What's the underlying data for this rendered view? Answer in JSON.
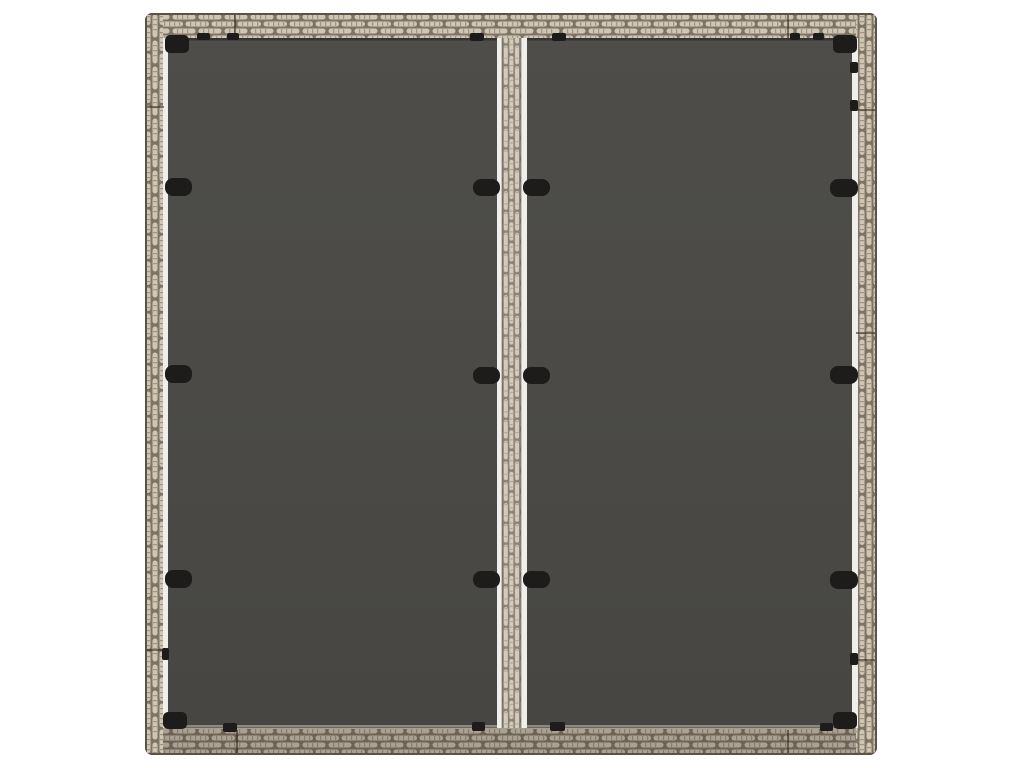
{
  "scene": {
    "alt_text": "Top-down product photo of a square grey poly rattan garden table top with two dark grey glass panels, a central rattan divider strip with white trim, and black glass retaining clips, on a plain white background.",
    "background_color": "#ffffff"
  },
  "photo": {
    "x": 145,
    "y": 13,
    "width": 732,
    "height": 742
  },
  "colors": {
    "background": "#ffffff",
    "glass": "#4b4a46",
    "glass_light": "#4e4d49",
    "glass_dark": "#474643",
    "strand": "#cfc6b4",
    "strand_tick": "#8b8272",
    "weave_gap": "#7d7466",
    "frame_base": "#a89e8d",
    "frame_outline": "#5a5346",
    "bottom_shade": "rgba(56,47,36,0.24)",
    "white_trim": "#f0eee8",
    "clip": "#1d1c1a",
    "seam": "rgba(45,38,29,0.55)"
  },
  "frame": {
    "thickness": 25,
    "seams": {
      "top_x": [
        90,
        643
      ],
      "bottom_x": [
        92,
        643
      ],
      "left_y": [
        94,
        637
      ],
      "right_y": [
        97,
        320,
        647
      ]
    }
  },
  "divider": {
    "white_left_x": 352,
    "rattan_x": 357,
    "rattan_w": 19,
    "white_right_x": 376,
    "white_right_w": 6
  },
  "clips": {
    "large": [
      {
        "x": 20,
        "y": 165,
        "w": 27,
        "h": 18
      },
      {
        "x": 20,
        "y": 352,
        "w": 27,
        "h": 18
      },
      {
        "x": 20,
        "y": 557,
        "w": 27,
        "h": 18
      },
      {
        "x": 685,
        "y": 166,
        "w": 28,
        "h": 18
      },
      {
        "x": 685,
        "y": 353,
        "w": 28,
        "h": 18
      },
      {
        "x": 685,
        "y": 558,
        "w": 28,
        "h": 18
      },
      {
        "x": 328,
        "y": 166,
        "w": 27,
        "h": 17
      },
      {
        "x": 328,
        "y": 354,
        "w": 27,
        "h": 17
      },
      {
        "x": 328,
        "y": 558,
        "w": 27,
        "h": 17
      },
      {
        "x": 378,
        "y": 166,
        "w": 27,
        "h": 17
      },
      {
        "x": 378,
        "y": 354,
        "w": 27,
        "h": 17
      },
      {
        "x": 378,
        "y": 558,
        "w": 27,
        "h": 17
      }
    ],
    "corners": [
      {
        "x": 20,
        "y": 22,
        "w": 24,
        "h": 18
      },
      {
        "x": 688,
        "y": 22,
        "w": 24,
        "h": 18
      },
      {
        "x": 18,
        "y": 699,
        "w": 24,
        "h": 17
      },
      {
        "x": 688,
        "y": 699,
        "w": 24,
        "h": 17
      }
    ],
    "tabs": [
      {
        "x": 52,
        "y": 20,
        "w": 13,
        "h": 7
      },
      {
        "x": 82,
        "y": 20,
        "w": 12,
        "h": 7
      },
      {
        "x": 325,
        "y": 20,
        "w": 14,
        "h": 8
      },
      {
        "x": 407,
        "y": 20,
        "w": 14,
        "h": 8
      },
      {
        "x": 645,
        "y": 20,
        "w": 10,
        "h": 7
      },
      {
        "x": 668,
        "y": 20,
        "w": 11,
        "h": 7
      },
      {
        "x": 78,
        "y": 710,
        "w": 14,
        "h": 9
      },
      {
        "x": 327,
        "y": 709,
        "w": 13,
        "h": 9
      },
      {
        "x": 405,
        "y": 709,
        "w": 15,
        "h": 9
      },
      {
        "x": 675,
        "y": 710,
        "w": 13,
        "h": 8
      },
      {
        "x": 705,
        "y": 49,
        "w": 8,
        "h": 11
      },
      {
        "x": 705,
        "y": 87,
        "w": 8,
        "h": 11
      },
      {
        "x": 705,
        "y": 640,
        "w": 8,
        "h": 12
      },
      {
        "x": 17,
        "y": 635,
        "w": 7,
        "h": 12
      }
    ]
  }
}
